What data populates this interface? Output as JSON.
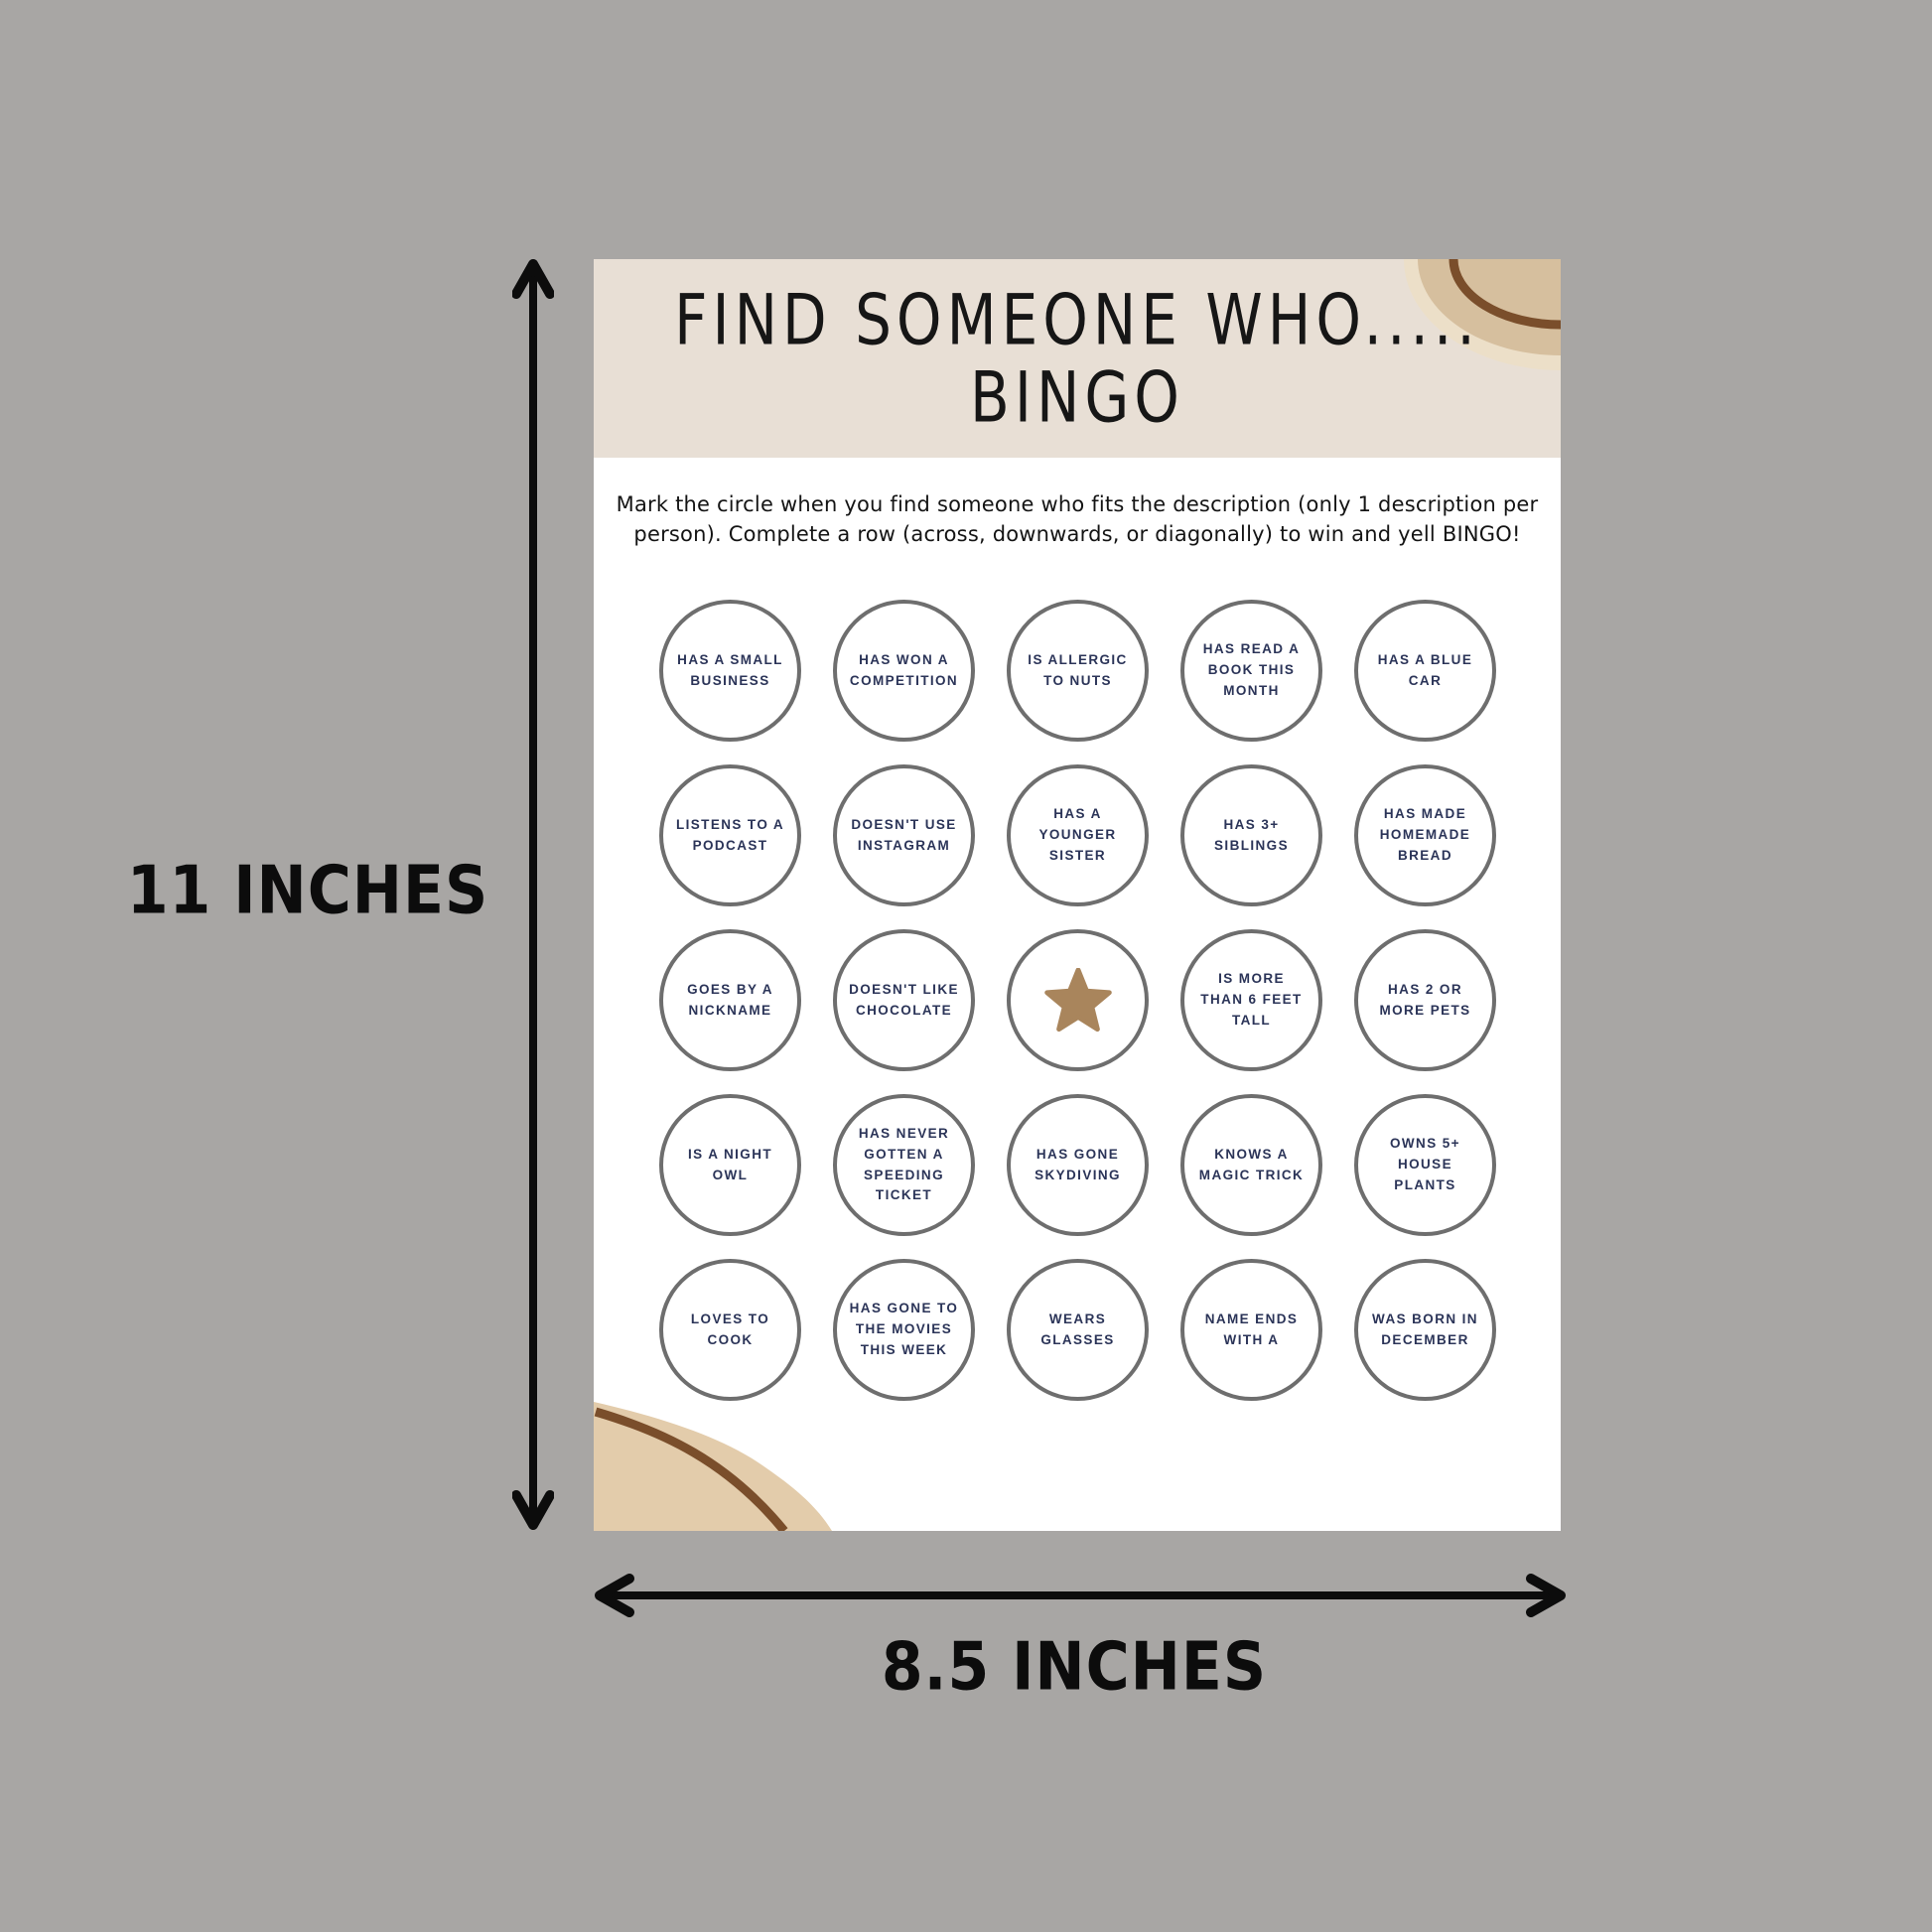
{
  "background_color": "#a8a6a4",
  "dimensions": {
    "height_label": "11 INCHES",
    "width_label": "8.5 INCHES"
  },
  "page": {
    "title_line1": "FIND SOMEONE WHO.....",
    "title_line2": "BINGO",
    "instructions": "Mark the circle when you find someone who fits the description (only 1 description per person). Complete a row (across, downwards, or diagonally) to win and yell BINGO!",
    "grid": {
      "rows": 5,
      "cols": 5,
      "cells": [
        {
          "label": "HAS A SMALL BUSINESS"
        },
        {
          "label": "HAS WON A COMPETITION"
        },
        {
          "label": "IS ALLERGIC TO NUTS"
        },
        {
          "label": "HAS READ A BOOK THIS MONTH"
        },
        {
          "label": "HAS A BLUE CAR"
        },
        {
          "label": "LISTENS TO A PODCAST"
        },
        {
          "label": "DOESN'T USE INSTAGRAM"
        },
        {
          "label": "HAS A YOUNGER SISTER"
        },
        {
          "label": "HAS 3+ SIBLINGS"
        },
        {
          "label": "HAS MADE HOMEMADE BREAD"
        },
        {
          "label": "GOES BY A NICKNAME"
        },
        {
          "label": "DOESN'T LIKE CHOCOLATE"
        },
        {
          "label": "",
          "icon": "star-free-space"
        },
        {
          "label": "IS MORE THAN 6 FEET TALL"
        },
        {
          "label": "HAS 2 OR MORE PETS"
        },
        {
          "label": "IS A NIGHT OWL"
        },
        {
          "label": "HAS NEVER GOTTEN A SPEEDING TICKET"
        },
        {
          "label": "HAS GONE SKYDIVING"
        },
        {
          "label": "KNOWS A MAGIC TRICK"
        },
        {
          "label": "OWNS 5+ HOUSE PLANTS"
        },
        {
          "label": "LOVES TO COOK"
        },
        {
          "label": "HAS GONE TO THE MOVIES THIS WEEK"
        },
        {
          "label": "WEARS GLASSES"
        },
        {
          "label": "NAME ENDS WITH A"
        },
        {
          "label": "WAS BORN IN DECEMBER"
        }
      ]
    },
    "colors": {
      "header_band": "#e8dfd5",
      "circle_border": "#6e6e6e",
      "circle_text": "#2b3458",
      "star_fill": "#a9855c",
      "corner_tan": "#d6bf9e",
      "corner_light_tan": "#e3ccab",
      "corner_cream": "#ecdfc8",
      "corner_line_brown": "#7a4e2b",
      "annotation_black": "#0c0c0c"
    }
  }
}
